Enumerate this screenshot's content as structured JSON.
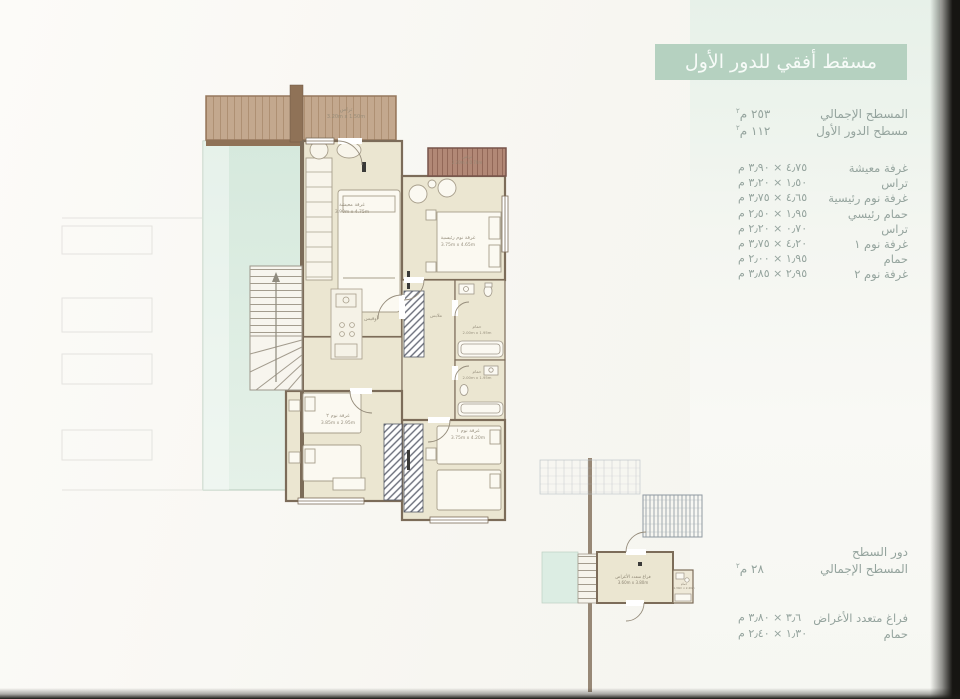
{
  "first_floor": {
    "header": "مسقط أفقي للدور الأول",
    "areas": [
      {
        "label": "المسطح الإجمالي",
        "value_unit": "٢٥٣ م",
        "sup": "٢"
      },
      {
        "label": "مسطح الدور الأول",
        "value_unit": "١١٢ م",
        "sup": "٢"
      }
    ],
    "rooms": [
      {
        "name": "غرفة معيشة",
        "dims": "٤٫٧٥ × ٣٫٩٠ م"
      },
      {
        "name": "تراس",
        "dims": "١٫٥٠ × ٣٫٢٠ م"
      },
      {
        "name": "غرفة نوم رئيسية",
        "dims": "٤٫٦٥ × ٣٫٧٥ م"
      },
      {
        "name": "حمام رئيسي",
        "dims": "١٫٩٥ × ٢٫٥٠ م"
      },
      {
        "name": "تراس",
        "dims": "٠٫٧٠ × ٢٫٢٠ م"
      },
      {
        "name": "غرفة نوم ١",
        "dims": "٤٫٢٠ × ٣٫٧٥ م"
      },
      {
        "name": "حمام",
        "dims": "١٫٩٥ × ٢٫٠٠ م"
      },
      {
        "name": "غرفة نوم ٢",
        "dims": "٢٫٩٥ × ٣٫٨٥ م"
      }
    ]
  },
  "roof_floor": {
    "title": "دور السطح",
    "areas": [
      {
        "label": "المسطح الإجمالي",
        "value_unit": "٢٨ م",
        "sup": "٢"
      }
    ],
    "rooms": [
      {
        "name": "فراغ متعدد الأغراض",
        "dims": "٣٫٦ × ٣٫٨٠ م"
      },
      {
        "name": "حمام",
        "dims": "١٫٣٠ × ٢٫٤٠ م"
      }
    ]
  },
  "plan_labels": {
    "terrace_top": {
      "name": "تراس",
      "dims": "3.20m x 1.50m"
    },
    "terrace_small": {
      "name": "تراس",
      "dims": "2.20m x 0.70m"
    },
    "living": {
      "name": "غرفة معيشة",
      "dims": "3.90m x 4.75m"
    },
    "master": {
      "name": "غرفة نوم رئيسية",
      "dims": "3.75m x 4.65m"
    },
    "office": {
      "name": "أوفيس"
    },
    "closet": {
      "name": "ملابس"
    },
    "bath_master": {
      "name": "حمام",
      "dims": "2.00m x 1.95m"
    },
    "bath_shared": {
      "name": "حمام",
      "dims": "2.00m x 1.95m"
    },
    "bedroom1": {
      "name": "غرفة نوم ١",
      "dims": "3.75m x 4.20m"
    },
    "bedroom2": {
      "name": "غرفة نوم ٢",
      "dims": "3.85m x 2.95m"
    },
    "roof_room": {
      "name": "فراغ متعدد الأغراض",
      "dims": "3.60m x 3.80m"
    },
    "roof_bath": {
      "name": "حمام",
      "dims": "1.30m x 2.40m"
    }
  },
  "colors": {
    "accent_header": "#b5d1c0",
    "text": "#95a49e",
    "mint_band": "#e9f1ea",
    "wall": "#7c6c59",
    "wood_deck": "#c3a88e",
    "wood_dark": "#b28876",
    "room_fill": "#ebe6d1",
    "green_void": "#ddeee3"
  }
}
